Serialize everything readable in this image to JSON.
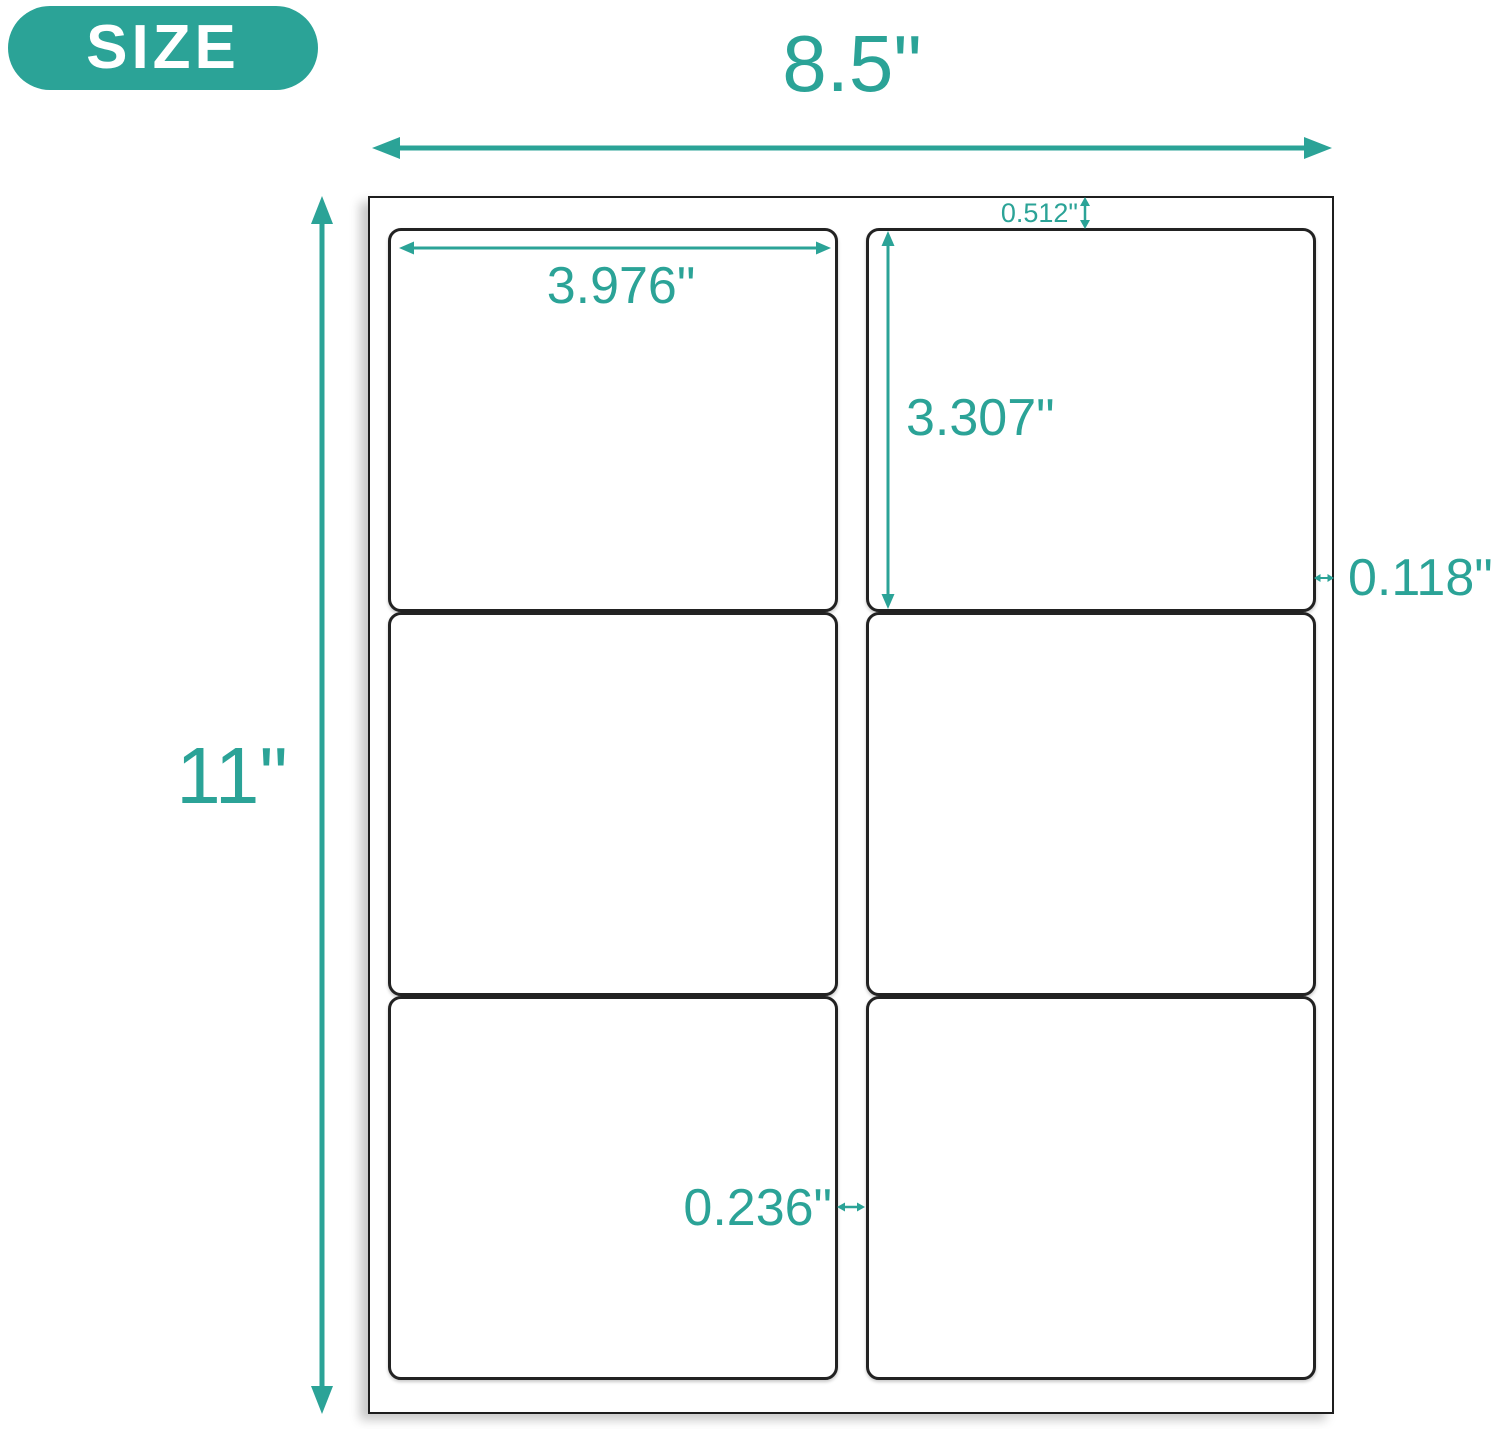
{
  "badge": {
    "label": "SIZE"
  },
  "colors": {
    "accent": "#2ba397",
    "sheet_border": "#1d1d1d",
    "label_border": "#222222"
  },
  "sheet": {
    "grid": {
      "rows": 3,
      "columns": 2,
      "label_count": 6
    }
  },
  "dimensions": {
    "sheet_width": {
      "label": "8.5\"",
      "arrow": "horizontal-double"
    },
    "sheet_height": {
      "label": "11\"",
      "arrow": "vertical-double"
    },
    "label_width": {
      "label": "3.976\"",
      "arrow": "horizontal-double"
    },
    "label_height": {
      "label": "3.307\"",
      "arrow": "vertical-double"
    },
    "top_margin": {
      "label": "0.512\"",
      "arrow": "vertical-double"
    },
    "side_margin": {
      "label": "0.118\"",
      "arrow": "horizontal-double"
    },
    "column_gap": {
      "label": "0.236\"",
      "arrow": "horizontal-double"
    }
  }
}
